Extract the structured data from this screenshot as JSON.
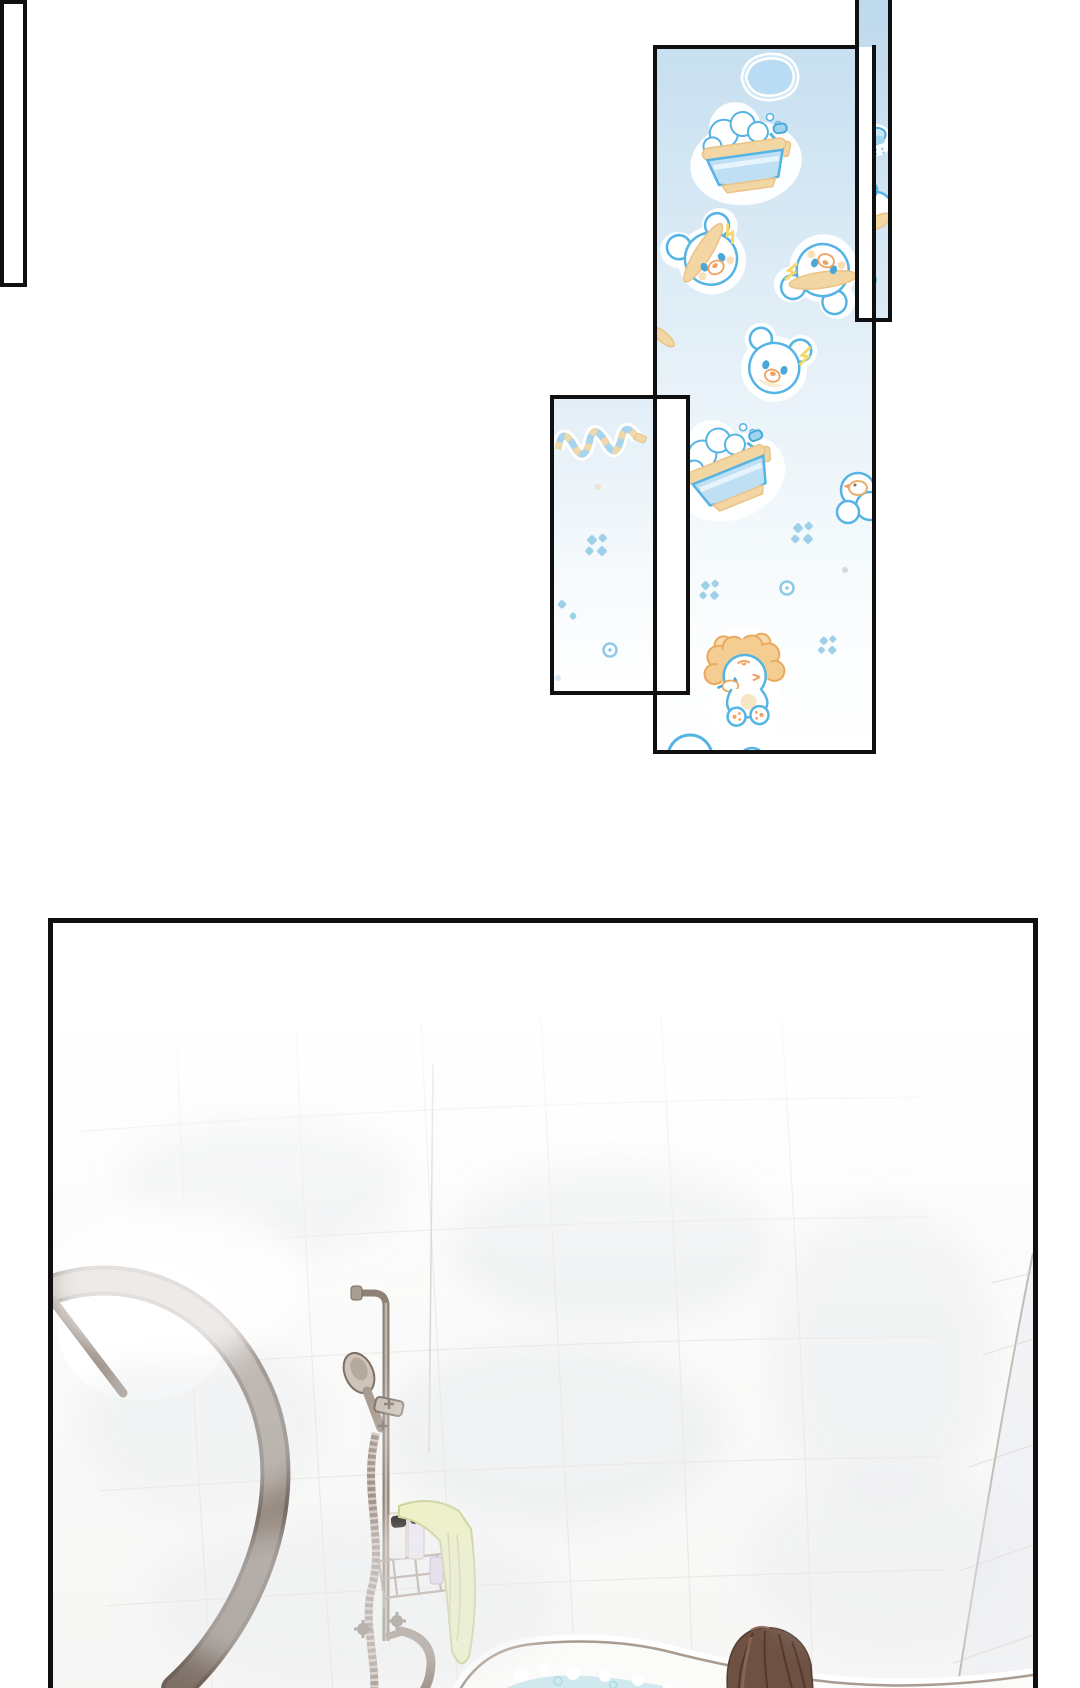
{
  "page": {
    "kind": "webtoon comic page, no text",
    "background": "#ffffff"
  },
  "colors": {
    "panel_border": "#101010",
    "pattern_sky_top": "#c7dff0",
    "pattern_sky_deep": "#bcd8ec",
    "pattern_sky_mid": "#e6f1f8",
    "pattern_sky_bottom": "#ffffff",
    "pale_sky_top": "#e2eef7",
    "sticker_outline": "#55b4e3",
    "sticker_soft_blue": "#a9d6ef",
    "sticker_tub_body": "#bfe0f4",
    "sticker_tan": "#f2d7a4",
    "sticker_tan_edge": "#ecc287",
    "sticker_orange": "#f2a05f",
    "sticker_yellow": "#f6d96d",
    "bubble_fill": "#b9dcf4",
    "dot_blue": "#9fd0ea",
    "scene_wall": "#f6f6f5",
    "steam_gray": "#e8ebee",
    "tile_line": "#d8d3ce",
    "door_frame": "#8e8076",
    "door_frame_dark": "#6f6158",
    "fixture_metal": "#9b8d82",
    "fixture_light": "#cfc4ba",
    "towel_yellow": "#eff1c3",
    "towel_line": "#ccd193",
    "sunglasses": "#2f2823",
    "bottle_lavender": "#e3d7ec",
    "tub_rim_line": "#a99b90",
    "water_blue": "#cfe9ef",
    "water_deep": "#bfe2ea",
    "hair_brown": "#6e5143",
    "hair_dark": "#4e362b",
    "hair_light": "#8a6a58"
  },
  "panels": {
    "pattern_panel": {
      "description": "tall panel filled with baby-blue bath-time sticker wallpaper",
      "stickers": [
        "soap-bubble-blob",
        "bubble-bathtub-with-sprayer",
        "bear-with-hat-left",
        "bear-with-hat-right",
        "plain-bear-face",
        "hat-brim-fragment",
        "tilted-bathtub-with-sprayer",
        "duck-in-suds-fragment",
        "bubble-dot-clusters",
        "lion-cub-with-duck",
        "big-bubble-fragment"
      ]
    },
    "top_strip_panel": {
      "description": "narrow strip panel cut by the top edge, same wallpaper",
      "stickers": [
        "shower-head-fragment",
        "bear-fragment"
      ]
    },
    "left_overlap_panel": {
      "description": "pale overlapping rectangle of the same wallpaper fading to white",
      "stickers": [
        "coiled-shower-hose",
        "bubble-dot-clusters",
        "hex-bubble"
      ]
    },
    "connector_bar": {
      "description": "thin empty white bar linking the pattern panels to the bathroom panel"
    },
    "bathroom_panel": {
      "description": "steamy white bathroom seen from above: curved glass shower door, tiled walls, shower pole with hand shower and ribbed hose, wire caddy with bottles, sunglasses and pale-yellow towel, tub faucet with cross handles, bathtub with pale blue water and the back of a brown-haired head"
    }
  }
}
